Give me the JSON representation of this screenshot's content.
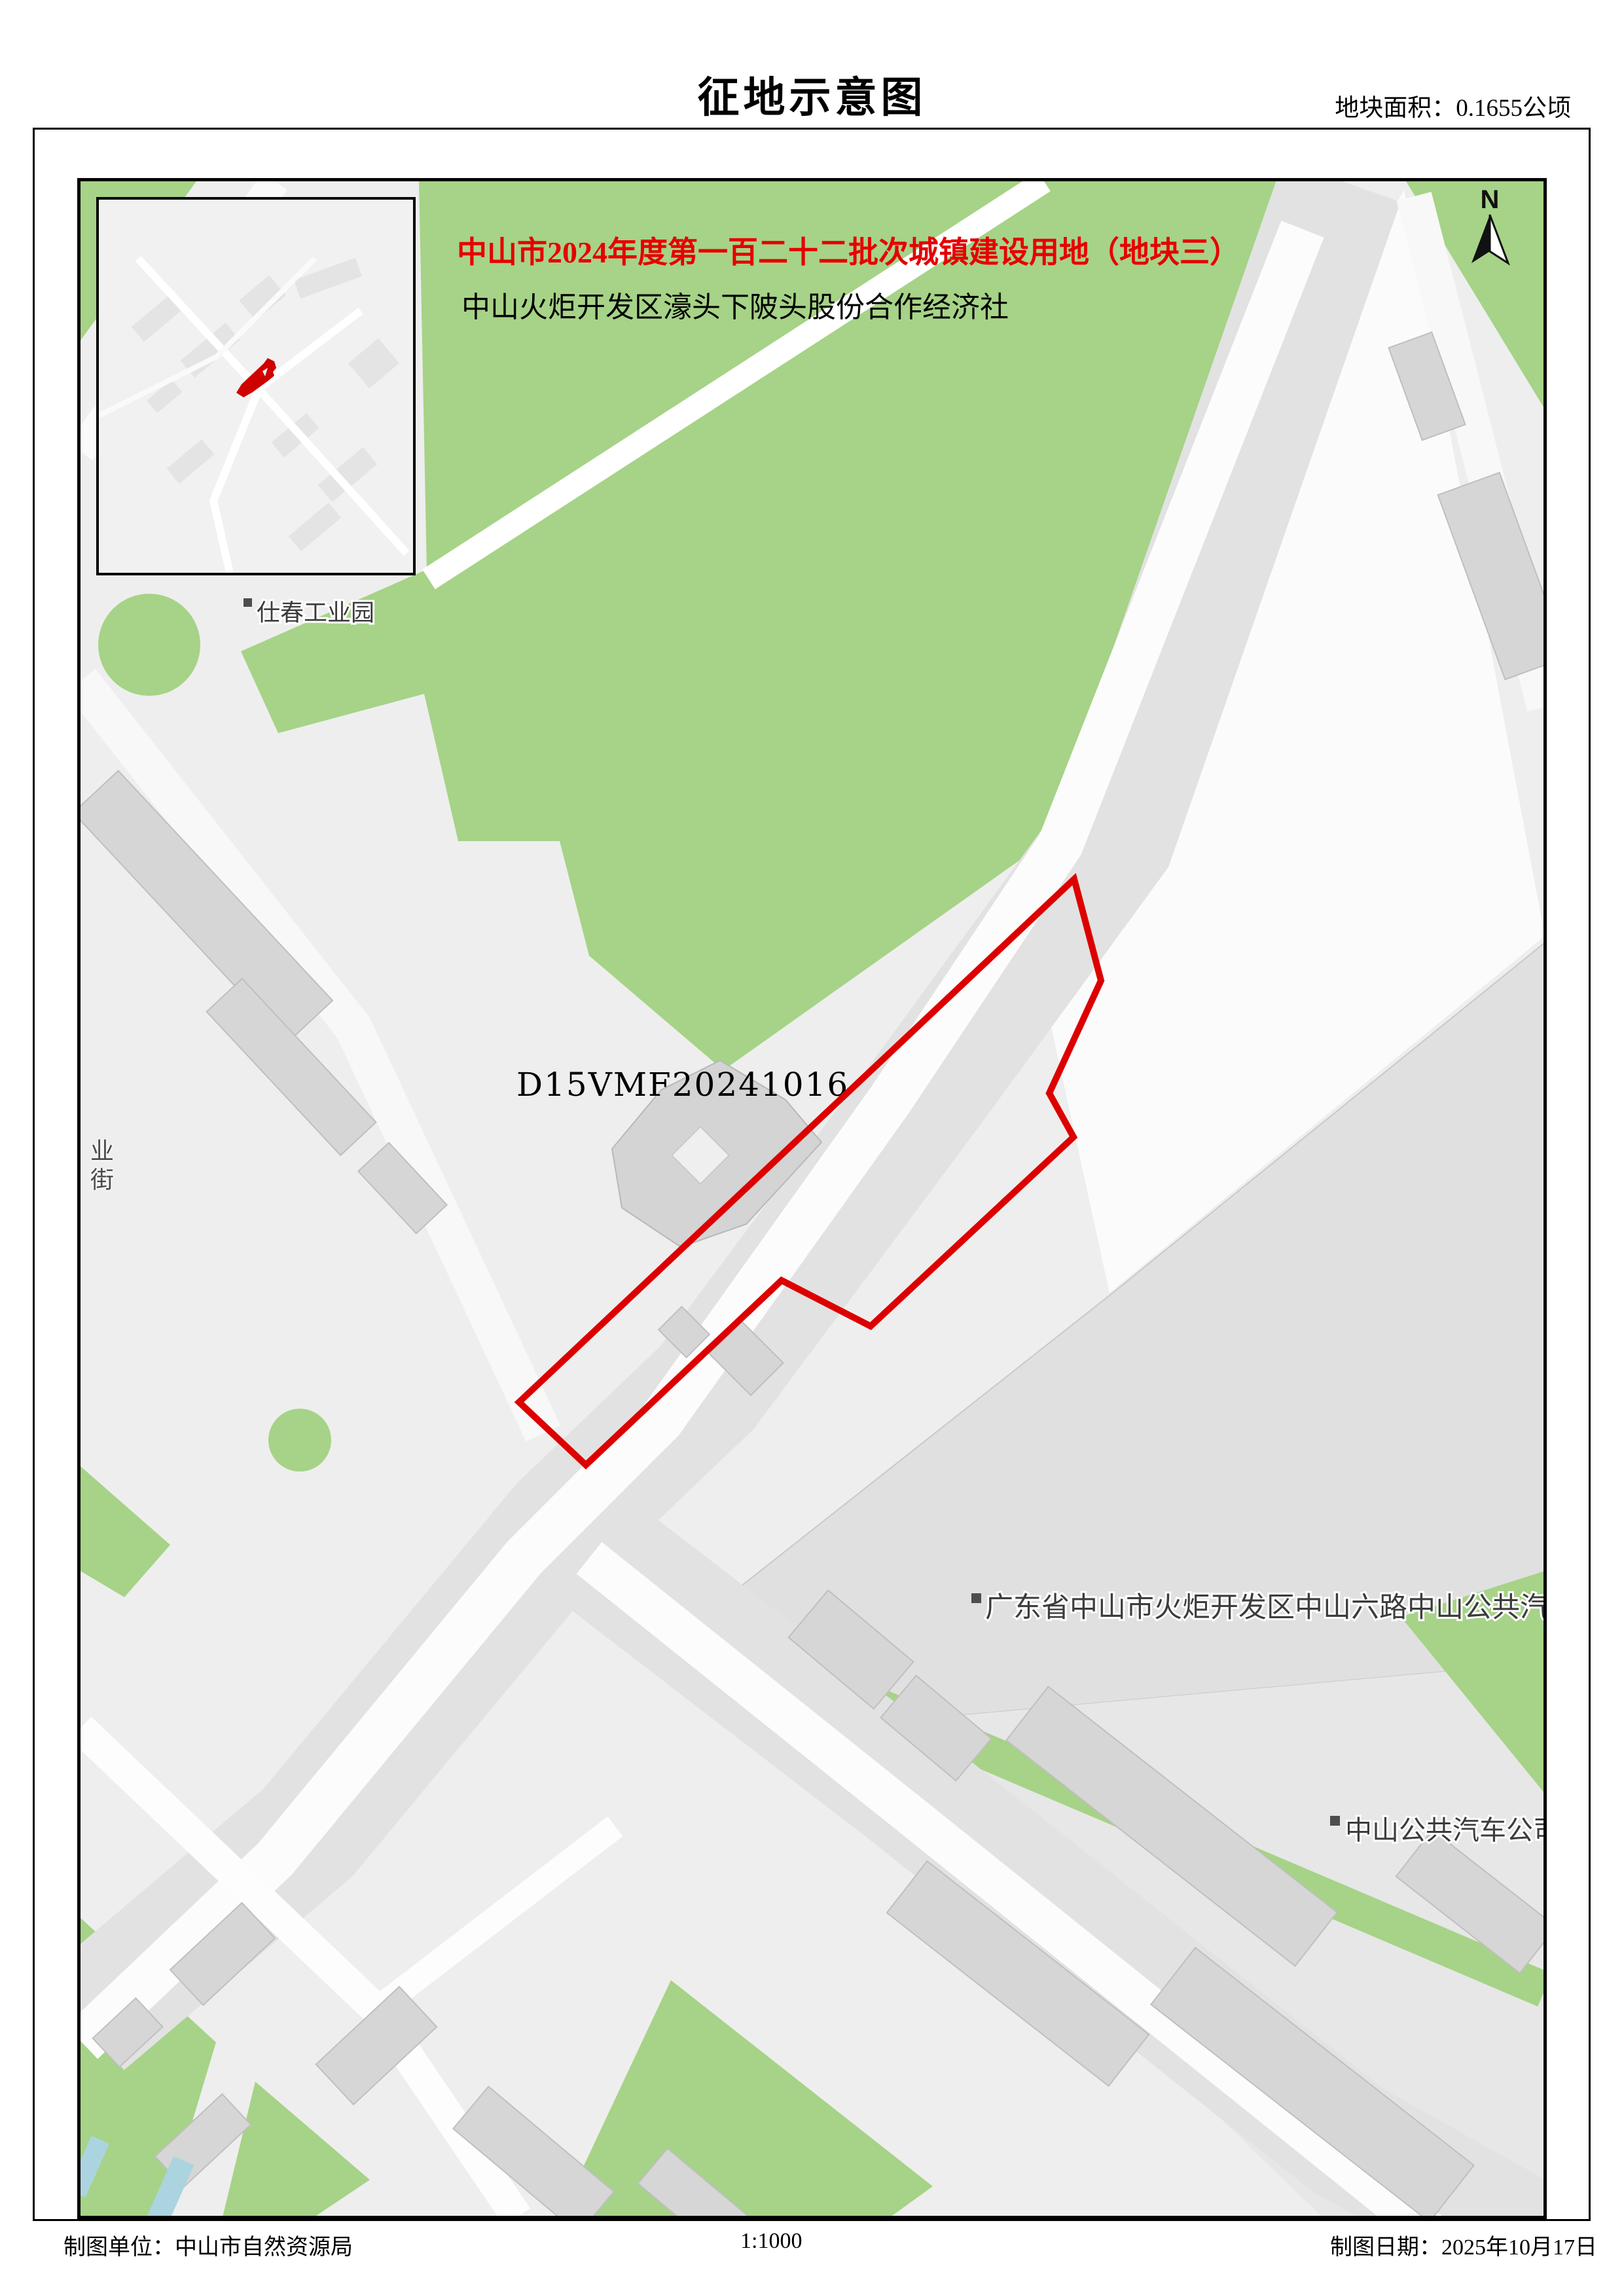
{
  "header": {
    "title": "征地示意图",
    "area_note": "地块面积：0.1655公顷"
  },
  "map": {
    "annotation": {
      "line1": "中山市2024年度第一百二十二批次城镇建设用地（地块三）",
      "line2": "中山火炬开发区濠头下陂头股份合作经济社"
    },
    "parcel": {
      "code": "D15VMF20241016",
      "outline_color": "#dd0000",
      "area_text": "0.1655公顷"
    },
    "labels": {
      "industrial_park": "仕春工业园",
      "road_long": "广东省中山市火炬开发区中山六路中山公共汽",
      "bus_company": "中山公共汽车公司",
      "street_vertical": "业街"
    },
    "north_label": "N",
    "colors": {
      "green": "#a6d387",
      "road_gray": "#e2e2e2",
      "road_white": "#fcfcfc",
      "building": "#d6d6d6",
      "water": "#abd4e0",
      "base_gray": "#eeeeee",
      "parcel_red": "#dd0000"
    }
  },
  "footer": {
    "agency": "制图单位：中山市自然资源局",
    "scale": "1:1000",
    "date": "制图日期：2025年10月17日"
  }
}
